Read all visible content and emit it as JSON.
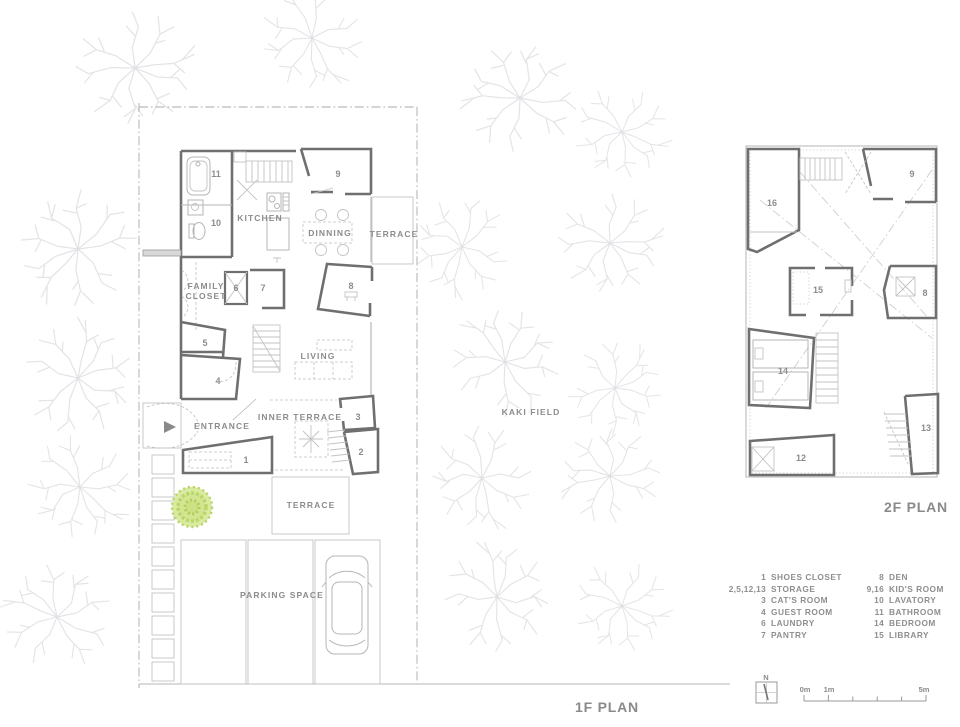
{
  "colors": {
    "wall": "#6f6f6f",
    "thin_line": "#c3c3c3",
    "text": "#8c8c8c",
    "kaki_tree_green": "#c5dc78"
  },
  "plan_1f": {
    "title": "1F PLAN",
    "labels": {
      "kitchen": "KITCHEN",
      "dinning": "DINNING",
      "terrace_east": "TERRACE",
      "family_line1": "FAMILY",
      "family_line2": "CLOSET",
      "living": "LIVING",
      "entrance": "ENTRANCE",
      "inner_terrace": "INNER TERRACE",
      "terrace_south": "TERRACE",
      "parking": "PARKING SPACE"
    },
    "room_numbers": {
      "r1": "1",
      "r2": "2",
      "r3": "3",
      "r4": "4",
      "r5": "5",
      "r6": "6",
      "r7": "7",
      "r8": "8",
      "r9": "9",
      "r10": "10",
      "r11": "11"
    }
  },
  "plan_2f": {
    "title": "2F PLAN",
    "room_numbers": {
      "r8": "8",
      "r9": "9",
      "r12": "12",
      "r13": "13",
      "r14": "14",
      "r15": "15",
      "r16": "16"
    }
  },
  "site": {
    "field_label": "KAKI FIELD"
  },
  "legend": {
    "left": [
      {
        "num": "1",
        "label": "SHOES CLOSET"
      },
      {
        "num": "2,5,12,13",
        "label": "STORAGE"
      },
      {
        "num": "3",
        "label": "CAT'S ROOM"
      },
      {
        "num": "4",
        "label": "GUEST ROOM"
      },
      {
        "num": "6",
        "label": "LAUNDRY"
      },
      {
        "num": "7",
        "label": "PANTRY"
      }
    ],
    "right": [
      {
        "num": "8",
        "label": "DEN"
      },
      {
        "num": "9,16",
        "label": "KID'S ROOM"
      },
      {
        "num": "10",
        "label": "LAVATORY"
      },
      {
        "num": "11",
        "label": "BATHROOM"
      },
      {
        "num": "14",
        "label": "BEDROOM"
      },
      {
        "num": "15",
        "label": "LIBRARY"
      }
    ]
  },
  "scale_bar": {
    "north": "N",
    "tick0": "0m",
    "tick1": "1m",
    "tick5": "5m"
  }
}
